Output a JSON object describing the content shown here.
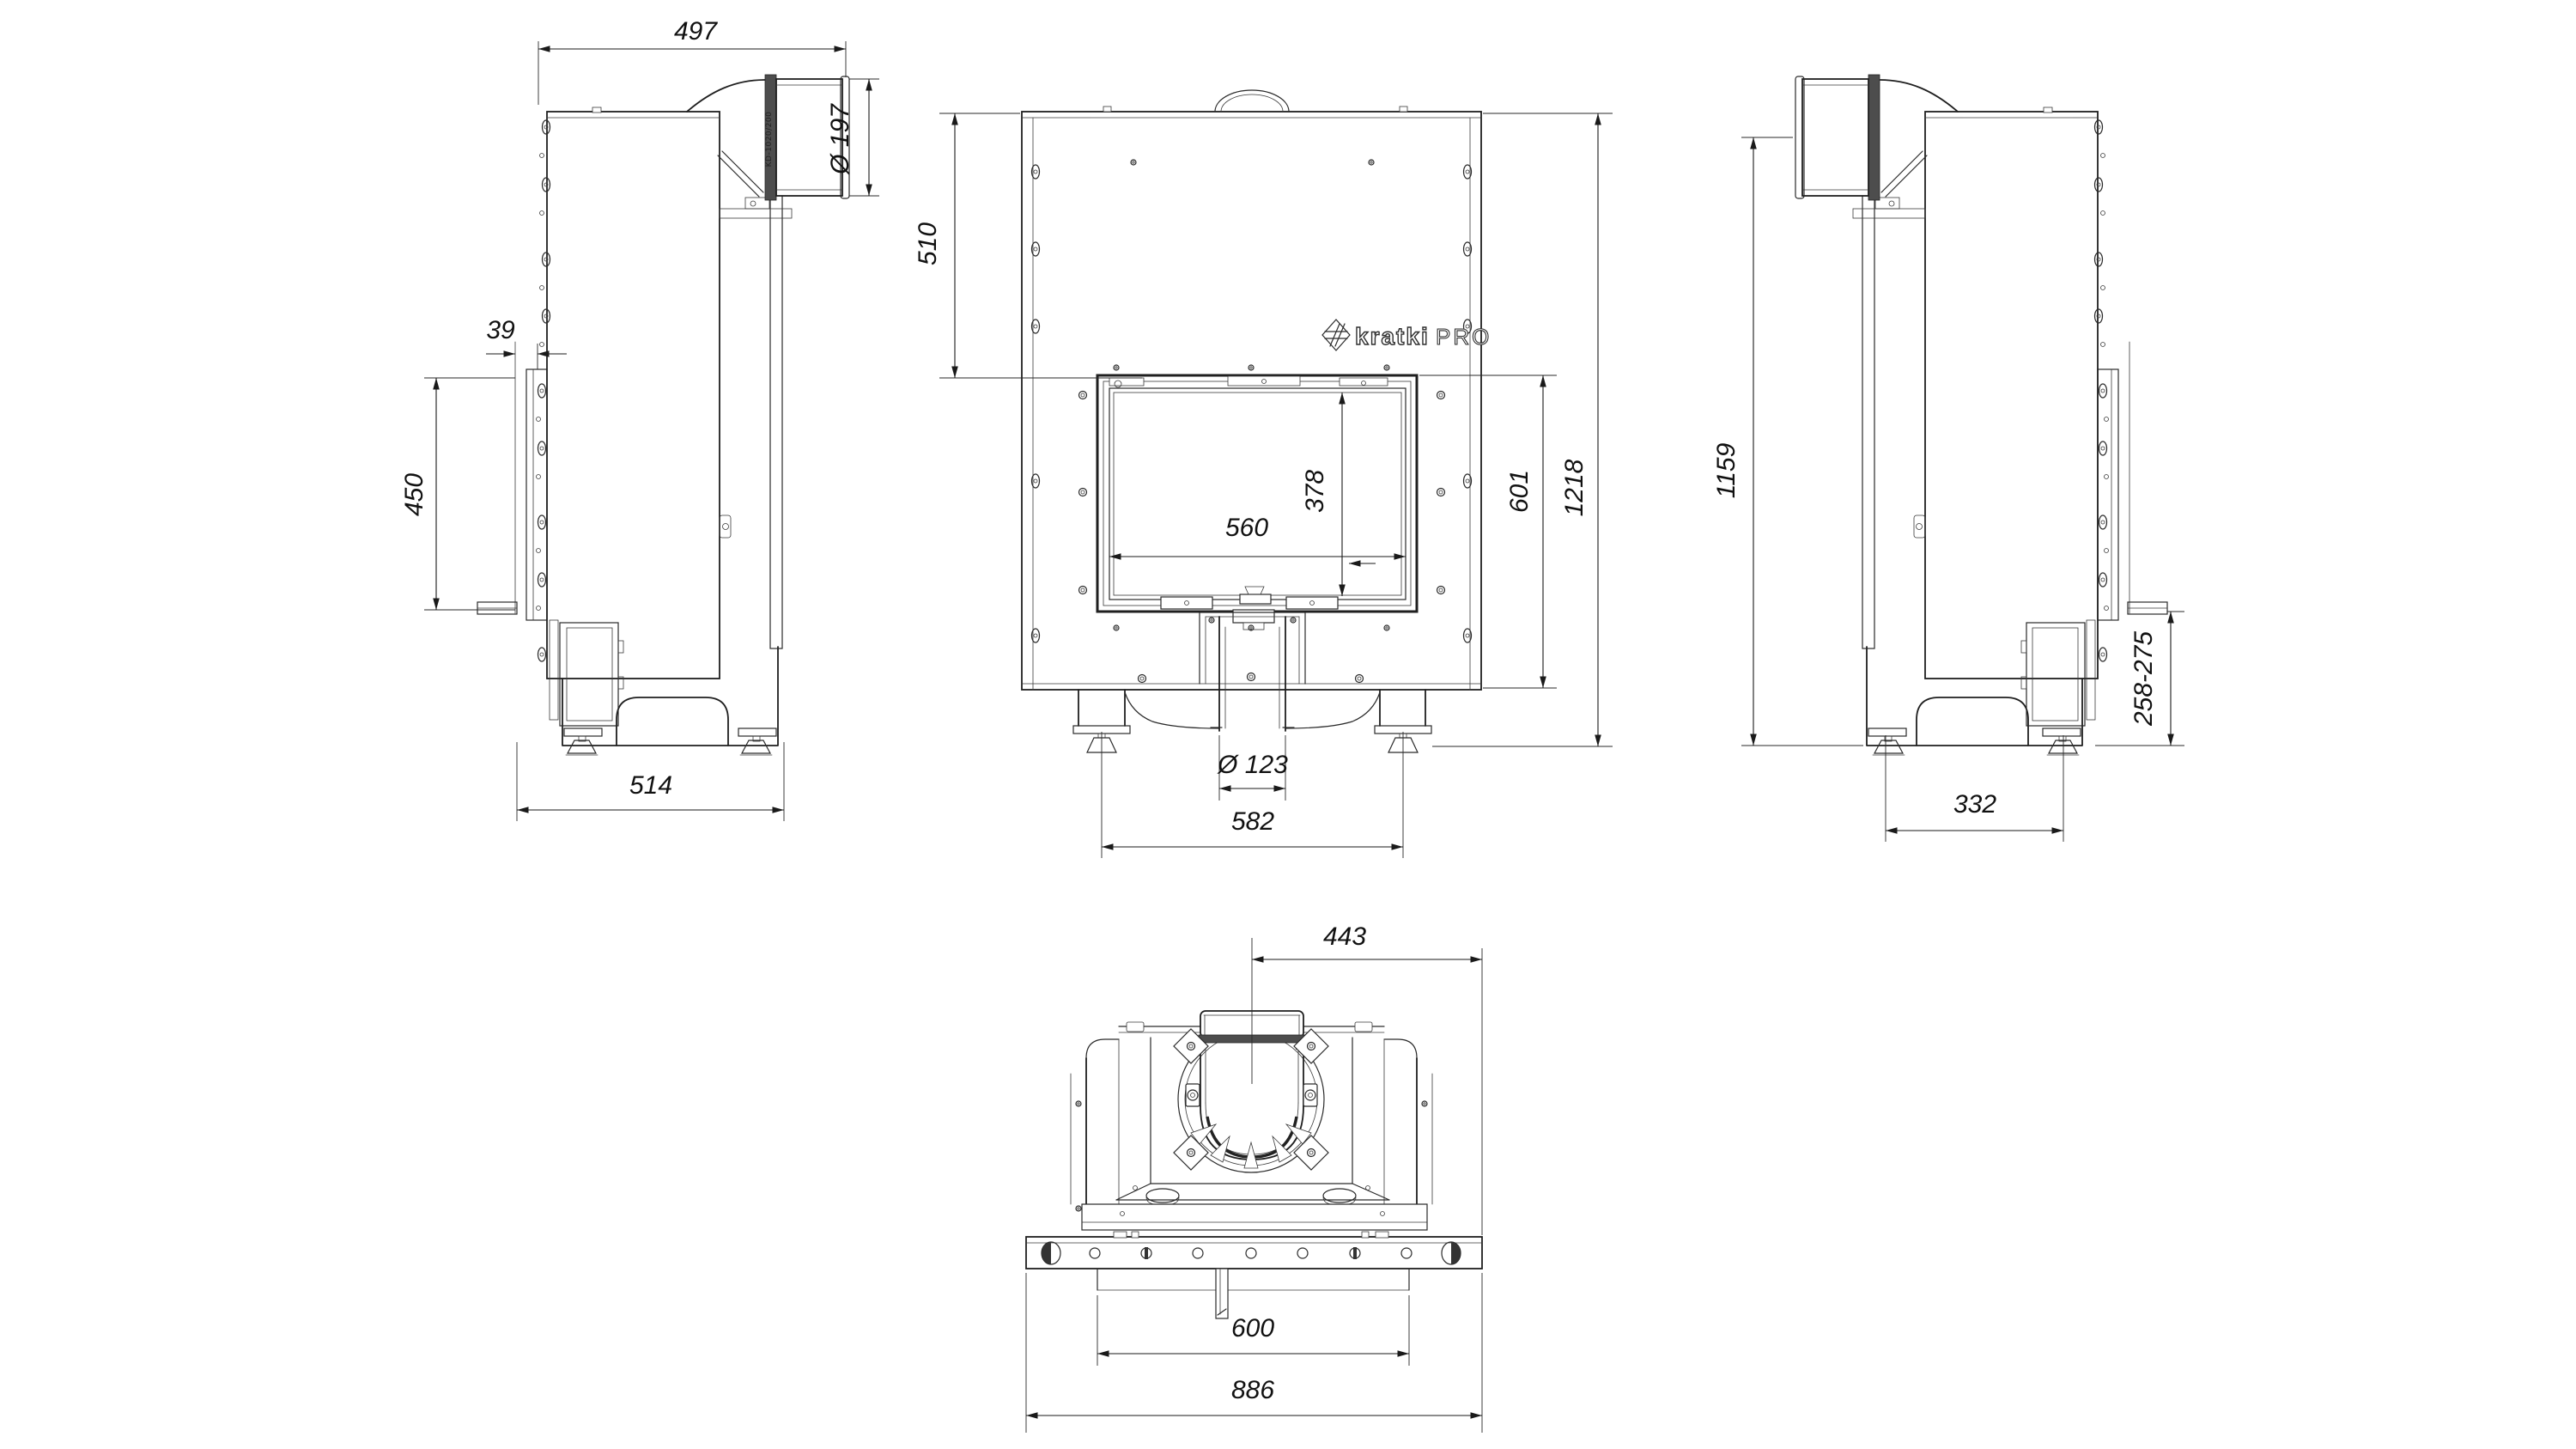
{
  "drawing": {
    "brand": {
      "name": "kratki",
      "suffix": "PRO"
    },
    "pipe_label": "KD-1020/200",
    "views": {
      "left_side": {
        "dims": {
          "top_width": "497",
          "flue_diameter": "Ø 197",
          "front_offset": "39",
          "frame_height": "450",
          "base_depth": "514"
        }
      },
      "front": {
        "dims": {
          "top_to_glass": "510",
          "glass_width": "560",
          "glass_height": "378",
          "door_height": "601",
          "total_height": "1218",
          "air_inlet_diameter": "Ø 123",
          "feet_spacing": "582"
        }
      },
      "right_side": {
        "dims": {
          "flue_axis_height": "1159",
          "base_clearance": "258-275",
          "feet_spacing": "332"
        }
      },
      "top": {
        "dims": {
          "flue_center_to_edge": "443",
          "inner_width": "600",
          "total_width": "886"
        }
      }
    }
  }
}
